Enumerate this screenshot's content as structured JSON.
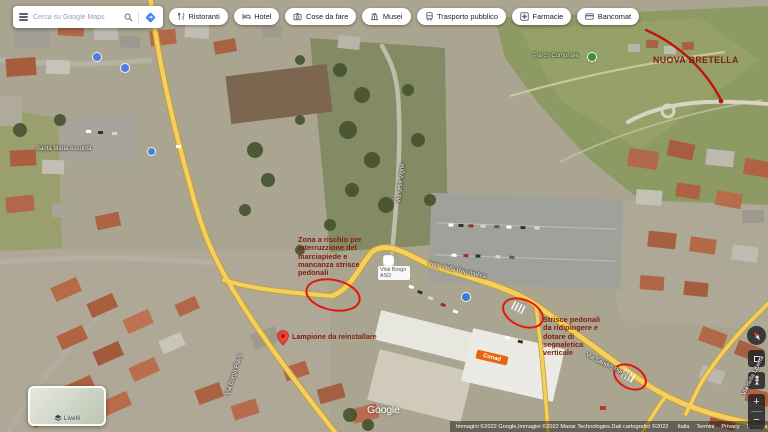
{
  "search": {
    "placeholder": "Cerca su Google Maps"
  },
  "toolbar": {
    "buttons": [
      {
        "label": "Ristoranti",
        "icon": "restaurant-icon"
      },
      {
        "label": "Hotel",
        "icon": "hotel-icon"
      },
      {
        "label": "Cose da fare",
        "icon": "attractions-icon"
      },
      {
        "label": "Musei",
        "icon": "museum-icon"
      },
      {
        "label": "Trasporto pubblico",
        "icon": "transit-icon"
      },
      {
        "label": "Farmacie",
        "icon": "pharmacy-icon"
      },
      {
        "label": "Bancomat",
        "icon": "atm-icon"
      }
    ]
  },
  "annotations": {
    "zone_risk": "Zona a rischio per interruzzione del marciapiede e mancanza strisce pedonali",
    "lamp": "Lampione da reinstallare",
    "crosswalks": "Strisce pedonali da ridipingere e dotare di segnaletica verticale",
    "new_road": "NUOVA BRETELLA",
    "text_color": "#7f1f10",
    "ellipse_color": "#e3170d"
  },
  "map": {
    "street_labels": [
      {
        "text": "Via Borgo Piave"
      },
      {
        "text": "Via delle Vigne"
      },
      {
        "text": "Viale della Repubblica"
      },
      {
        "text": "Via Sandro Pertini"
      },
      {
        "text": "Via della Libertà"
      }
    ],
    "poi_labels": {
      "church": "Santa Maria Assunta",
      "park": "Parco Comunale",
      "club": "Vital Borgo ASD",
      "supermarket": "Conad"
    }
  },
  "controls": {
    "layers_label": "Livelli",
    "zoom_in": "+",
    "zoom_out": "−"
  },
  "watermark": "Google",
  "attribution": {
    "credits": "Immagini ©2022 Google,Immagini ©2022 Maxar Technologies,Dati cartografici ©2022",
    "links": [
      "Italia",
      "Termini",
      "Privacy",
      "Segnala un errore nella mappa"
    ],
    "scale_label": "20 m"
  }
}
